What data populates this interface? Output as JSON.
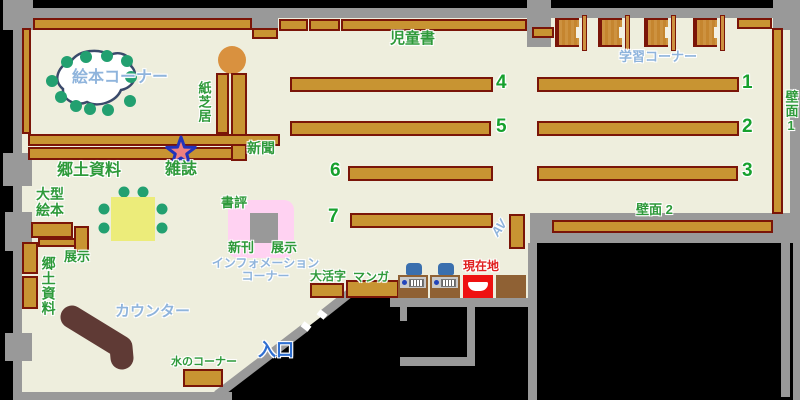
{
  "colors": {
    "floor": "#eeeedd",
    "outside": "#000000",
    "wall": "#999999",
    "shelf": "#c89432",
    "shelf_border": "#7a1508",
    "label_green": "#2e9a3a",
    "label_light_blue": "#8fb4dc",
    "entrance_blue": "#2f6fd0",
    "current_location_red": "#e02020",
    "counter_brown": "#5f3a35",
    "table_yellow": "#ecec7a",
    "chair_teal": "#22a070",
    "display_pink": "#ffd2f2",
    "station_chair_blue": "#3a6fae"
  },
  "labels": {
    "children_books": "児童書",
    "study_corner": "学習コーナー",
    "wall_1": "壁面1",
    "wall_2": "壁面 2",
    "picture_book_corner": "絵本コーナー",
    "kamishibai": "紙芝居",
    "newspaper": "新聞",
    "magazines": "雑誌",
    "local_materials": "郷土資料",
    "large_picture_books": "大型\n絵本",
    "display_left": "展示",
    "local_materials_side": "郷土資料",
    "book_review": "書評",
    "new_arrivals": "新刊",
    "display_center": "展示",
    "information_corner": "インフォメーション\nコーナー",
    "large_print": "大活字",
    "manga": "マンガ",
    "current_location": "現在地",
    "av": "AV",
    "counter": "カウンター",
    "water_corner": "水のコーナー",
    "entrance": "入口"
  },
  "shelf_numbers": {
    "n1": "1",
    "n2": "2",
    "n3": "3",
    "n4": "4",
    "n5": "5",
    "n6": "6",
    "n7": "7"
  }
}
